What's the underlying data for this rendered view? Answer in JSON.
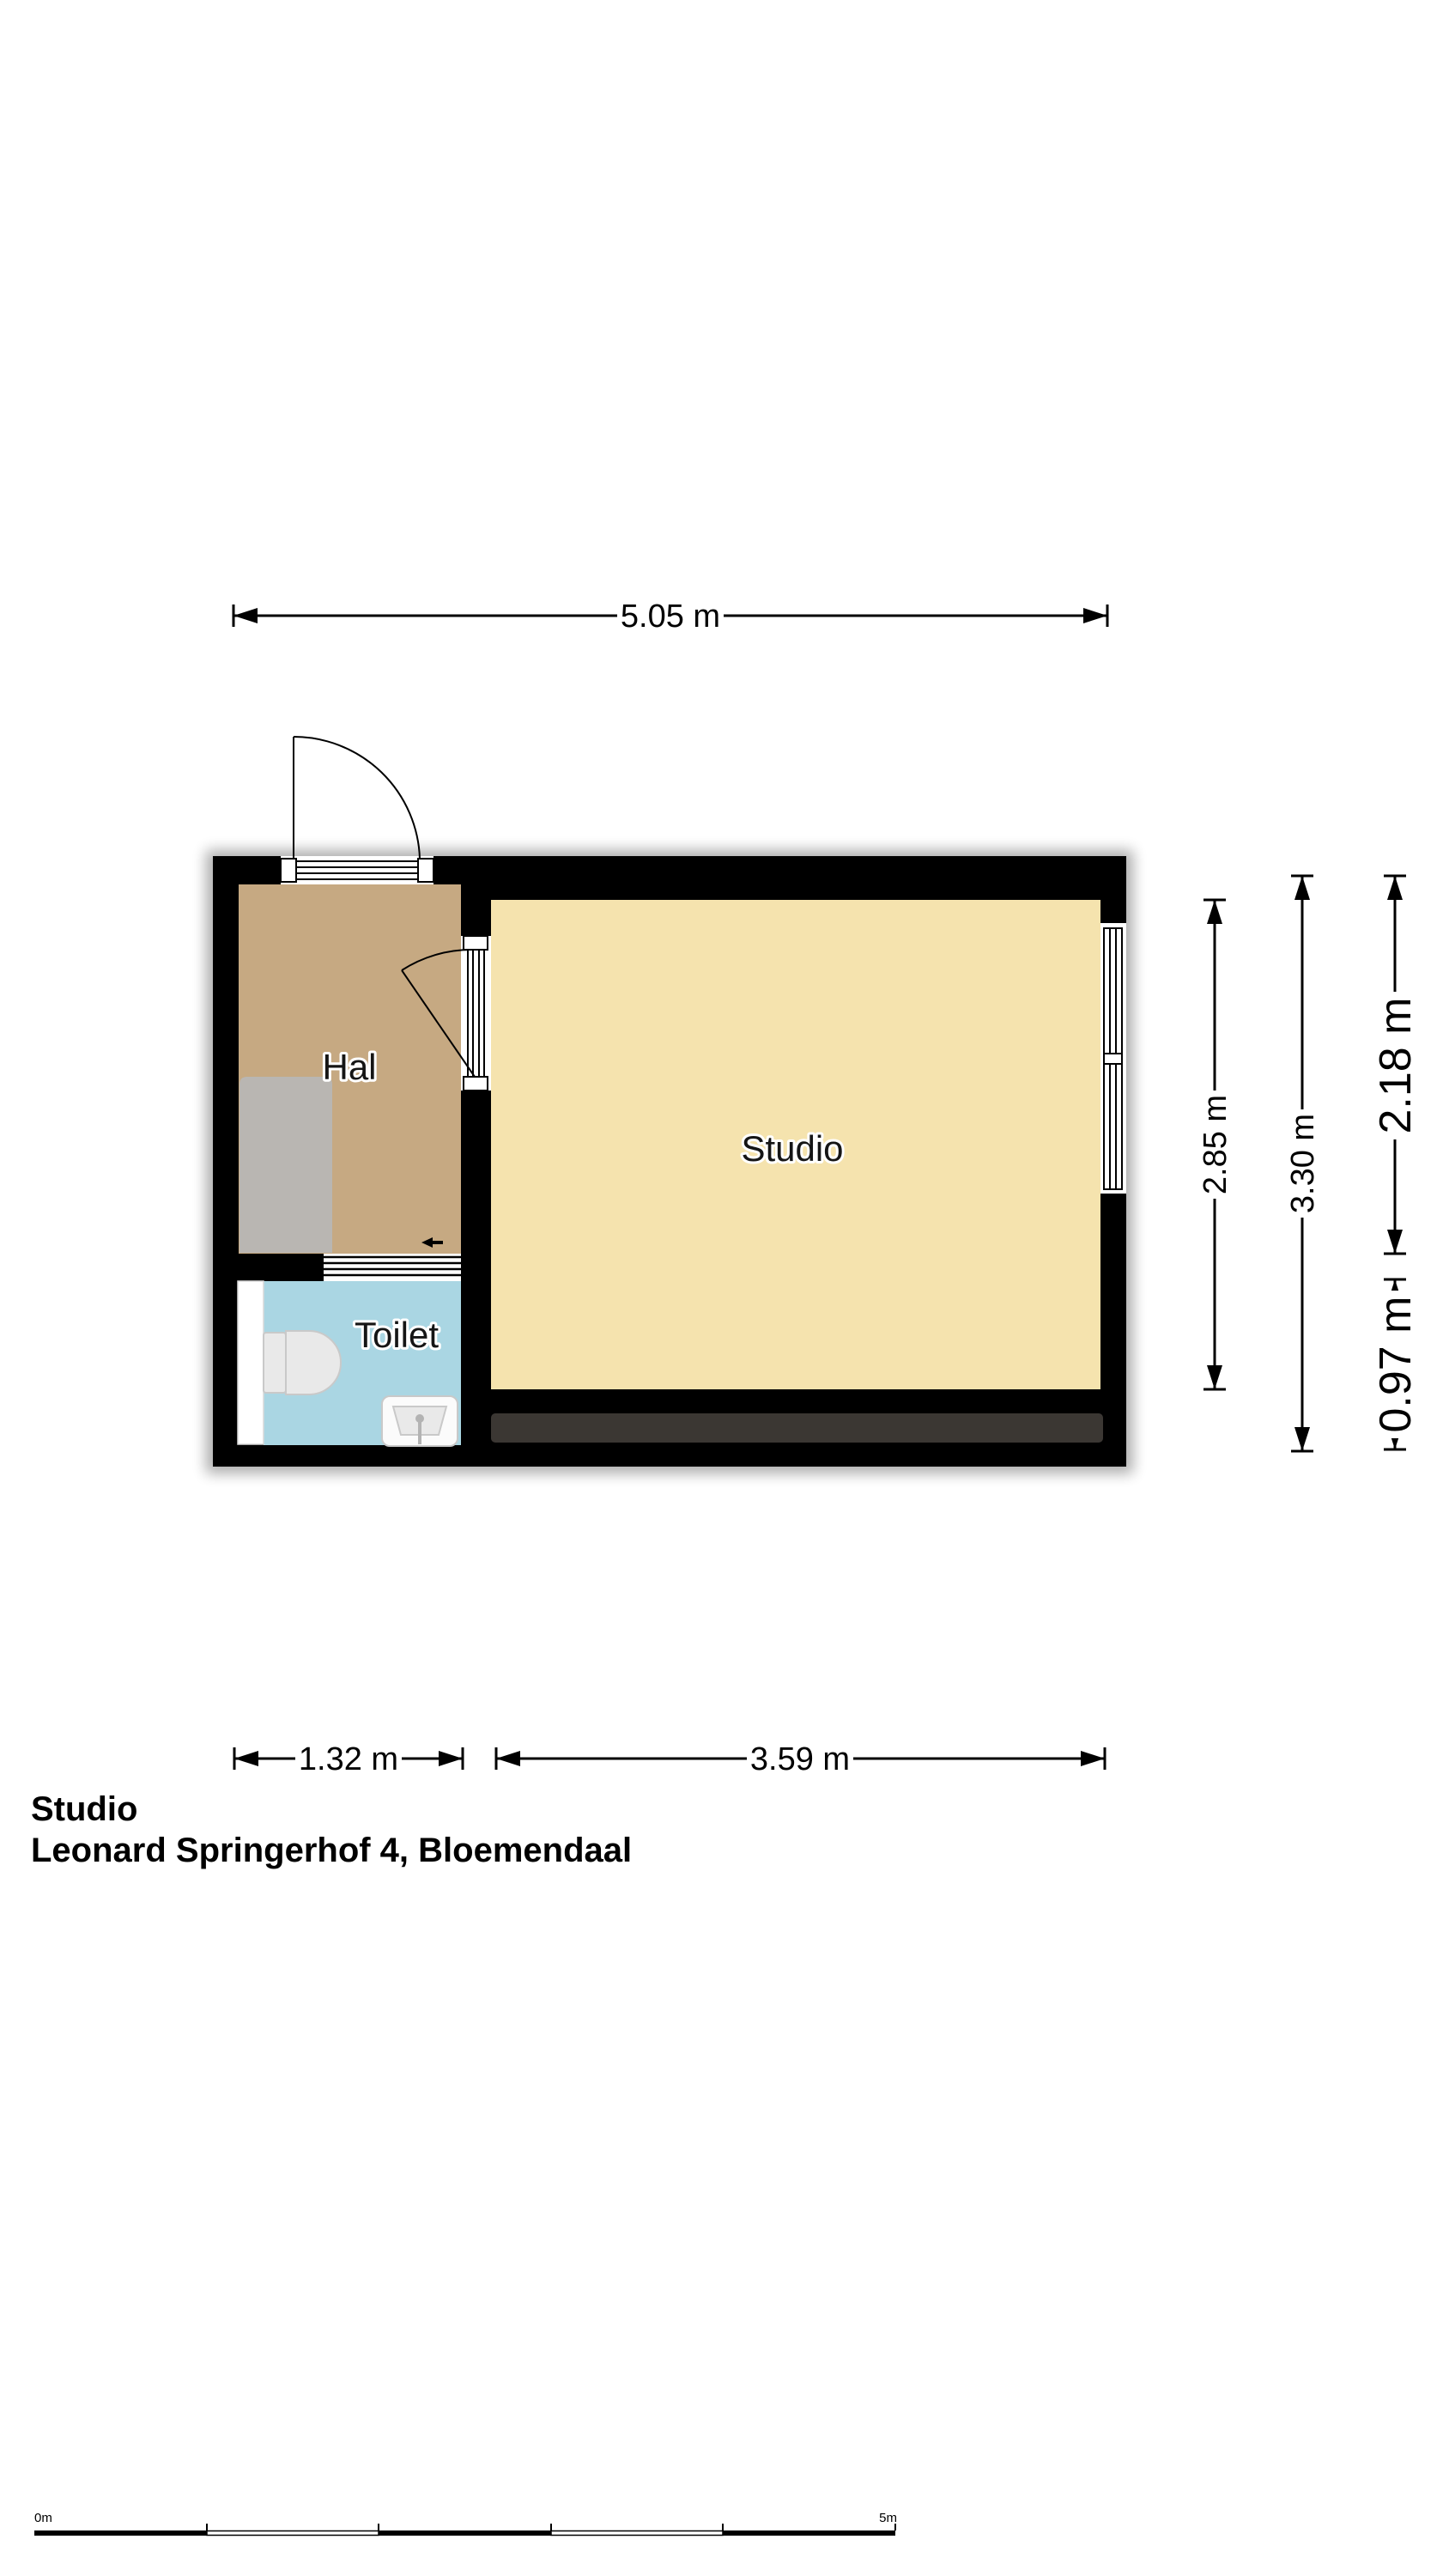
{
  "plan": {
    "rooms": [
      {
        "id": "hal",
        "label": "Hal",
        "color": "#c6a982"
      },
      {
        "id": "studio",
        "label": "Studio",
        "color": "#f5e3ae"
      },
      {
        "id": "toilet",
        "label": "Toilet",
        "color": "#aad6e3"
      }
    ],
    "wall_color": "#000000",
    "balcony_color": "#3b3733",
    "appliance_color": "#b9b6b2"
  },
  "dimensions": {
    "width_total": "5.05 m",
    "width_hal": "1.32 m",
    "width_studio": "3.59 m",
    "height_studio": "2.85 m",
    "height_total": "3.30 m",
    "height_window_top": "2.18 m",
    "height_window_bottom": "0.97 m"
  },
  "scale_bar": {
    "start": "0m",
    "end": "5m"
  },
  "footer": {
    "line1": "Studio",
    "line2": "Leonard Springerhof 4, Bloemendaal"
  }
}
